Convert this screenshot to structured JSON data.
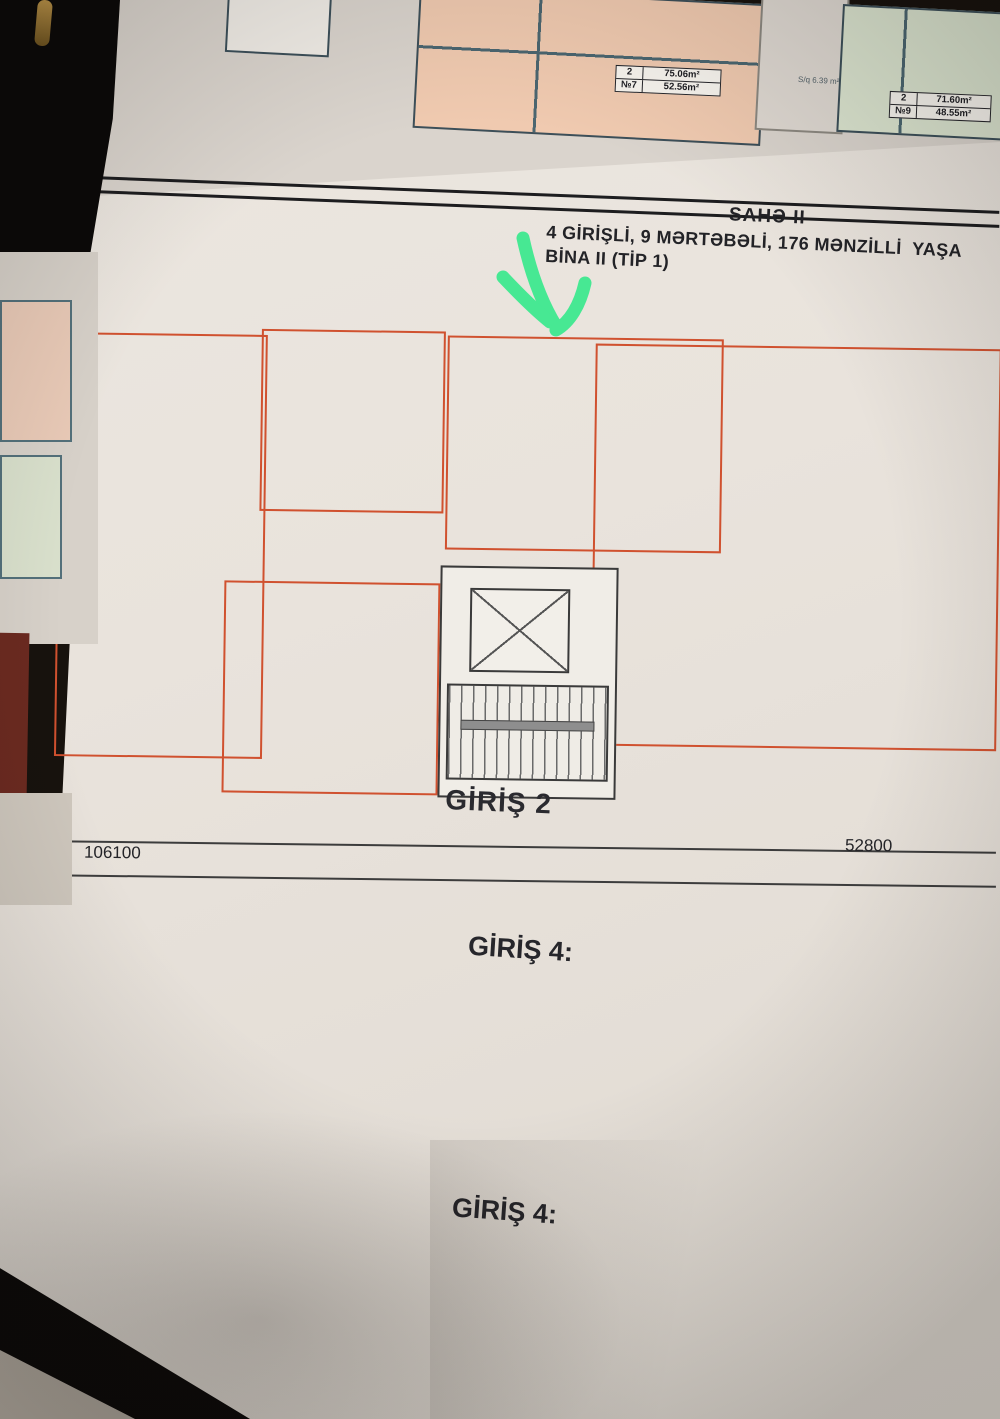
{
  "header": {
    "title": "SAHƏ II",
    "line1": "4 GİRİŞLİ, 9 MƏRTƏBƏLİ, 176 MƏNZİLLİ  YAŞA",
    "line2": "BİNA II (TİP 1)"
  },
  "top_sheets": {
    "small_room": "S/q 6.39 m²",
    "boxes": [
      {
        "k1": "2",
        "v1": "75.06m²",
        "k2": "№7",
        "v2": "52.56m²",
        "x": 618,
        "y": 38,
        "w": 106
      },
      {
        "k1": "2",
        "v1": "71.60m²",
        "k2": "№9",
        "v2": "48.55m²",
        "x": 893,
        "y": 52,
        "w": 102
      }
    ]
  },
  "plan": {
    "entrance_label": "GİRİŞ 2",
    "dims": {
      "left": "106100",
      "right": "52800",
      "edge": "00",
      "circle": "11"
    },
    "stairs": [
      {
        "t": "10",
        "x": 404,
        "y": 428
      },
      {
        "t": "10",
        "x": 400,
        "y": 498
      },
      {
        "t": "10",
        "x": 500,
        "y": 498
      }
    ],
    "outlines": [
      {
        "x": 6,
        "y": 80,
        "w": 208,
        "h": 424
      },
      {
        "x": 208,
        "y": 74,
        "w": 184,
        "h": 182
      },
      {
        "x": 394,
        "y": 78,
        "w": 276,
        "h": 214
      },
      {
        "x": 542,
        "y": 84,
        "w": 406,
        "h": 402
      },
      {
        "x": 174,
        "y": 326,
        "w": 216,
        "h": 212
      }
    ],
    "rooms": [
      {
        "n": "Eyvan",
        "a": "3.36 m²",
        "b": "2.74 m²",
        "x": 122,
        "y": 86,
        "w": 88,
        "h": 26,
        "p": "peach"
      },
      {
        "n": "Zal",
        "a": "20.28 m²",
        "b": "16.30 m²",
        "x": 12,
        "y": 112,
        "w": 112,
        "h": 150,
        "p": "peach"
      },
      {
        "n": "Metbex",
        "a": "12.46 m²",
        "b": "10.26 m²",
        "x": 124,
        "y": 112,
        "w": 86,
        "h": 150,
        "p": "peach"
      },
      {
        "n": "S/q",
        "a": "2.65 m²",
        "b": "1.60 m²",
        "x": 12,
        "y": 262,
        "w": 52,
        "h": 52,
        "p": "peach"
      },
      {
        "n": "Dehliz",
        "a": "9.18 m²",
        "b": "8.50 m²",
        "x": 64,
        "y": 262,
        "w": 146,
        "h": 76,
        "p": "peach"
      },
      {
        "n": "S/q",
        "a": "3.51 m²",
        "b": "2.76 m²",
        "x": 12,
        "y": 314,
        "w": 52,
        "h": 56,
        "p": "peach"
      },
      {
        "n": "Yataq otağı",
        "a": "12.22 m²",
        "b": "9.91 m²",
        "x": 12,
        "y": 370,
        "w": 96,
        "h": 106,
        "p": "peach"
      },
      {
        "n": "Yataq otağı",
        "a": "12.24 m²",
        "b": "10.38 m²",
        "x": 110,
        "y": 338,
        "w": 100,
        "h": 112,
        "p": "peach"
      },
      {
        "n": "Eyvan",
        "a": "3.00 m²",
        "b": "2.45 m²",
        "x": 108,
        "y": 452,
        "w": 102,
        "h": 26,
        "p": "peach"
      },
      {
        "n": "Eyvan",
        "a": "3.40 m²",
        "b": "2.92 m²",
        "x": 292,
        "y": 78,
        "w": 96,
        "h": 26,
        "p": "green"
      },
      {
        "n": "Yataq otağı",
        "a": "10.35 m²",
        "b": "8.72 m²",
        "x": 212,
        "y": 92,
        "w": 78,
        "h": 92,
        "p": "green"
      },
      {
        "n": "Ümumi otaq",
        "a": "21.48 m²",
        "b": "18.29 m²",
        "x": 290,
        "y": 104,
        "w": 100,
        "h": 152,
        "p": "green"
      },
      {
        "n": "S/q",
        "a": "4.33 m²",
        "b": "2.58 m²",
        "x": 212,
        "y": 184,
        "w": 39,
        "h": 64,
        "p": "green"
      },
      {
        "n": "Dehliz",
        "a": "3.95 m²",
        "b": "3.47 m²",
        "x": 251,
        "y": 184,
        "w": 39,
        "h": 64,
        "p": "green"
      },
      {
        "n": "Eyvan",
        "a": "3.40 m²",
        "b": "2.92 m²",
        "x": 398,
        "y": 82,
        "w": 94,
        "h": 26,
        "p": "peach"
      },
      {
        "n": "Metbex",
        "a": "10.70 m²",
        "b": "8.52 m²",
        "x": 398,
        "y": 108,
        "w": 56,
        "h": 106,
        "p": "peach"
      },
      {
        "n": "Yataq otağı",
        "a": "12.64 m²",
        "b": "11.21 m²",
        "x": 454,
        "y": 108,
        "w": 112,
        "h": 88,
        "p": "peach"
      },
      {
        "n": "S/q",
        "a": "4.79 m²",
        "b": "3.07 m²",
        "x": 398,
        "y": 214,
        "w": 54,
        "h": 68,
        "p": "peach"
      },
      {
        "n": "Dehliz",
        "a": "9.12 m²",
        "b": "7.24 m²",
        "x": 452,
        "y": 214,
        "w": 58,
        "h": 68,
        "p": "peach"
      },
      {
        "n": "Zal",
        "a": "19.72 m²",
        "b": "16.13 m²",
        "x": 556,
        "y": 100,
        "w": 112,
        "h": 168,
        "p": "peach"
      },
      {
        "n": "Eyvan",
        "a": "3.00 m²",
        "b": "2.55 m²",
        "x": 662,
        "y": 88,
        "w": 84,
        "h": 26,
        "p": "green"
      },
      {
        "n": "Eyvan",
        "a": "3.00 m²",
        "b": "2.55 m²",
        "x": 748,
        "y": 88,
        "w": 88,
        "h": 26,
        "p": "green"
      },
      {
        "n": "Yataq otağı",
        "a": "12.76 m²",
        "b": "10.69 m²",
        "x": 650,
        "y": 114,
        "w": 96,
        "h": 104,
        "p": "green"
      },
      {
        "n": "Yataq otağı",
        "a": "12.76 m²",
        "b": "10.69 m²",
        "x": 746,
        "y": 114,
        "w": 96,
        "h": 104,
        "p": "green"
      },
      {
        "n": "S/q",
        "a": "3.32 m²",
        "b": "2.81 m²",
        "x": 688,
        "y": 218,
        "w": 58,
        "h": 46,
        "p": "green"
      },
      {
        "n": "S/q",
        "a": "3.32 m²",
        "b": "2.81 m²",
        "x": 746,
        "y": 218,
        "w": 58,
        "h": 46,
        "p": "green"
      },
      {
        "n": "Dehliz",
        "a": "10.60 m²",
        "b": "9.30 m²",
        "x": 546,
        "y": 258,
        "w": 168,
        "h": 56,
        "p": "green"
      },
      {
        "n": "S/q",
        "a": "2.63 m²",
        "b": "1.57 m²",
        "x": 718,
        "y": 264,
        "w": 54,
        "h": 46,
        "p": "green"
      },
      {
        "n": "S/q",
        "a": "2.63 m²",
        "b": "1.57 m²",
        "x": 774,
        "y": 264,
        "w": 54,
        "h": 46,
        "p": "green"
      },
      {
        "n": "Dehliz",
        "a": "10.60 m²",
        "b": "9.30 m²",
        "x": 830,
        "y": 258,
        "w": 116,
        "h": 56,
        "p": "white"
      },
      {
        "n": "Metbex",
        "a": "14.49 m²",
        "b": "11.61 m²",
        "x": 546,
        "y": 314,
        "w": 96,
        "h": 140,
        "p": "green"
      },
      {
        "n": "Zal",
        "a": "18.81 m²",
        "b": "15.66 m²",
        "x": 642,
        "y": 320,
        "w": 120,
        "h": 134,
        "p": "green"
      },
      {
        "n": "Zal",
        "a": "18.81 m²",
        "b": "15.66 m²",
        "x": 764,
        "y": 320,
        "w": 100,
        "h": 134,
        "p": "green"
      },
      {
        "n": "Metbex",
        "a": "14.49 m²",
        "b": "11.61 m²",
        "x": 866,
        "y": 314,
        "w": 80,
        "h": 140,
        "p": "green"
      },
      {
        "n": "Eyvan",
        "a": "3.20 m²",
        "b": "2.48 m²",
        "x": 562,
        "y": 454,
        "w": 84,
        "h": 28,
        "p": "green"
      },
      {
        "n": "Eyvan",
        "a": "3.20 m²",
        "b": "2.48 m²",
        "x": 876,
        "y": 454,
        "w": 70,
        "h": 28,
        "p": "green"
      },
      {
        "n": "Zal",
        "a": "19.72 m²",
        "b": "16.13 m²",
        "x": 846,
        "y": 112,
        "w": 100,
        "h": 146,
        "p": "white"
      },
      {
        "n": "S/q",
        "a": "4.34 m²",
        "b": "2.58 m²",
        "x": 196,
        "y": 348,
        "w": 46,
        "h": 62,
        "p": "white"
      },
      {
        "n": "Dehliz",
        "a": "3.95 m²",
        "b": "3.47 m²",
        "x": 242,
        "y": 348,
        "w": 46,
        "h": 62,
        "p": "white"
      },
      {
        "n": "Ümumi otaq",
        "a": "21.65 m²",
        "b": "15.64 m²",
        "x": 288,
        "y": 330,
        "w": 100,
        "h": 172,
        "p": "white"
      },
      {
        "n": "Yataq otağı",
        "a": "10.11 m²",
        "b": "8.12 m²",
        "x": 178,
        "y": 420,
        "w": 96,
        "h": 80,
        "p": "white"
      },
      {
        "n": "Eyvan",
        "a": "3.40 m²",
        "b": "2.83 m²",
        "x": 260,
        "y": 506,
        "w": 126,
        "h": 28,
        "p": "green"
      }
    ],
    "info_boxes": [
      {
        "k1": "3",
        "v1": "79.18m²",
        "k2": "№2",
        "v2": "44.74m²",
        "k3": "Net",
        "v3": "64.90m²",
        "k4": "",
        "v4": "36.59m²",
        "x": 85,
        "y": 18,
        "w": 100
      },
      {
        "k1": "2/1",
        "v1": "43.51m²",
        "k2": "№3",
        "v2": "31.83m²",
        "k3": "Net",
        "v3": "33.98m²",
        "k4": "",
        "v4": "25.01m²",
        "x": 290,
        "y": 18,
        "w": 100
      },
      {
        "k1": "2",
        "v1": "60.37m²",
        "k2": "№4",
        "v2": "32.36m²",
        "k3": "Net",
        "v3": "49.09m²",
        "k4": "",
        "v4": "27.34m²",
        "x": 478,
        "y": 208,
        "w": 90
      },
      {
        "k1": "2",
        "v1": "68.81m²",
        "k2": "№5",
        "v2": "31.57m²",
        "k3": "Net",
        "v3": "56.67m²",
        "k4": "",
        "v4": "26.35m²",
        "x": 636,
        "y": 326,
        "w": 94
      },
      {
        "k1": "2",
        "v1": "68.81m²",
        "k2": "№1",
        "v2": "31.57m²",
        "k3": "Net",
        "v3": "56.67m²",
        "k4": "",
        "v4": "26.35m²",
        "x": 800,
        "y": 330,
        "w": 84
      },
      {
        "k1": "2/1",
        "v1": "43.45m²",
        "k2": "№1",
        "v2": "31.76m²",
        "k3": "Net",
        "v3": "32.64m²",
        "k4": "",
        "v4": "23.76m²",
        "x": 172,
        "y": 512,
        "w": 86
      }
    ]
  },
  "stats": {
    "block1": {
      "lines": [
        {
          "t": "rin tikinti sahəsi     - 295.32 m²"
        },
        {
          "t": "rin təmiz sahəsi     - 237.28 m²"
        },
        {
          "t": "rin sayı"
        },
        {
          "t": "- 5 ədəd",
          "a": "r"
        },
        {
          "t": "2/1 otaq - 2 ədəd",
          "a": "r"
        },
        {
          "t": "2 otaq - 2 ədəd",
          "a": "r"
        },
        {
          "t": "3 otaq - 1 ədəd",
          "a": "r"
        }
      ]
    },
    "giris4a": {
      "heading": "GİRİŞ 4:",
      "lines": [
        {
          "t": "1. Mənzillərin tikinti sahəsi     - 370.9"
        },
        {
          "t": "2. Mənzillərin təmiz sahəsi     - 301.4"
        },
        {
          "t": "3. Mənzillərin sayı"
        },
        {
          "t": "- 6 ə",
          "a": "r"
        },
        {
          "t": "2/1 otaq - 2 ə",
          "a": "r"
        },
        {
          "t": "2 otaq - 2 ə",
          "a": "r"
        },
        {
          "t": "3/2 otaq - 1 ə",
          "a": "r"
        },
        {
          "t": "3 otaq - 1 ə",
          "a": "r"
        }
      ]
    },
    "block2": {
      "lines": [
        {
          "t": "tikinti sahəsi   - 2362.56 m²"
        },
        {
          "t": "təmiz sahəsi   - 1898.24 m²"
        },
        {
          "t": "sayı"
        },
        {
          "t": "- 40 ədəd",
          "a": "r"
        },
        {
          "t": "2/1 otaq - 16 ədəd",
          "a": "r"
        },
        {
          "t": "2 otaq - 16 ədəd",
          "a": "r"
        },
        {
          "t": "3 otaq - 8 ədəd",
          "a": "r"
        }
      ]
    },
    "giris4b": {
      "heading": "GİRİŞ 4:",
      "lines": [
        {
          "t": "1. Mənzillərin tikinti sahəsi    - 2967"
        },
        {
          "t": "2. Mənzillərin təmiz sahəsi    - 2411"
        },
        {
          "t": "3. Mənzillərin sayı"
        },
        {
          "t": "- 48",
          "a": "r"
        },
        {
          "t": "2/1 otaq - 16",
          "a": "r"
        },
        {
          "t": "2 otaq - 16",
          "a": "r"
        },
        {
          "t": "3/2 otaq -",
          "a": "r"
        }
      ]
    }
  },
  "colors": {
    "arrow_green": "#3ae98d",
    "apartment_outline": "#d0512f",
    "peach_room": "#f2c9ab",
    "green_room": "#dde7d2",
    "wall": "#35565c"
  }
}
